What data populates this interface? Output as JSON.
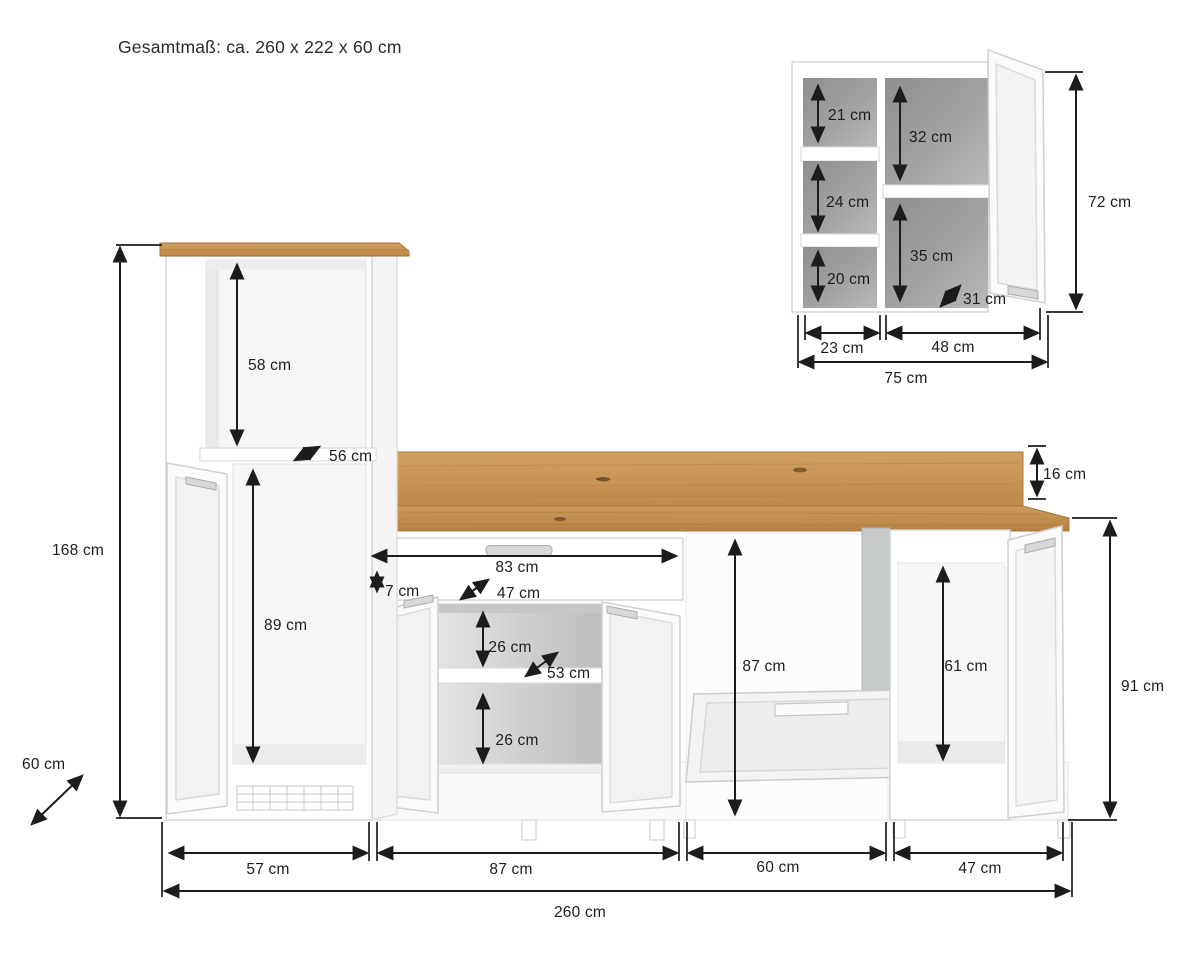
{
  "title": "Gesamtmaß: ca. 260 x 222 x 60 cm",
  "colors": {
    "oak": "#c99a5d",
    "oak_dark": "#b07c3f",
    "dimension_line": "#1c1c1c",
    "cabinet_outline": "#d5d5d5",
    "wall_cabinet_interior": "#9b9b9b",
    "base_cabinet_interior": "#d2d2d2"
  },
  "wall_cabinet": {
    "labels": {
      "left_top": "21 cm",
      "left_mid": "24 cm",
      "left_bottom": "20 cm",
      "right_top": "32 cm",
      "right_bottom": "35 cm",
      "depth": "31 cm",
      "height": "72 cm",
      "width_left": "23 cm",
      "width_right": "48 cm",
      "width_total": "75 cm"
    }
  },
  "base_unit": {
    "labels": {
      "niche_height": "58 cm",
      "niche_depth": "56 cm",
      "total_height": "168 cm",
      "fridge_niche_height": "89 cm",
      "depth": "60 cm",
      "drawer_width": "83 cm",
      "drawer_front_height": "7 cm",
      "drawer_depth": "47 cm",
      "compartment_top": "26 cm",
      "shelf_depth": "53 cm",
      "compartment_bottom": "26 cm",
      "dishwasher_niche_height": "87 cm",
      "right_niche_height": "61 cm",
      "backsplash_height": "16 cm",
      "worktop_height": "91 cm",
      "section1_width": "57 cm",
      "section2_width": "87 cm",
      "section3_width": "60 cm",
      "section4_width": "47 cm",
      "total_width": "260 cm"
    }
  }
}
